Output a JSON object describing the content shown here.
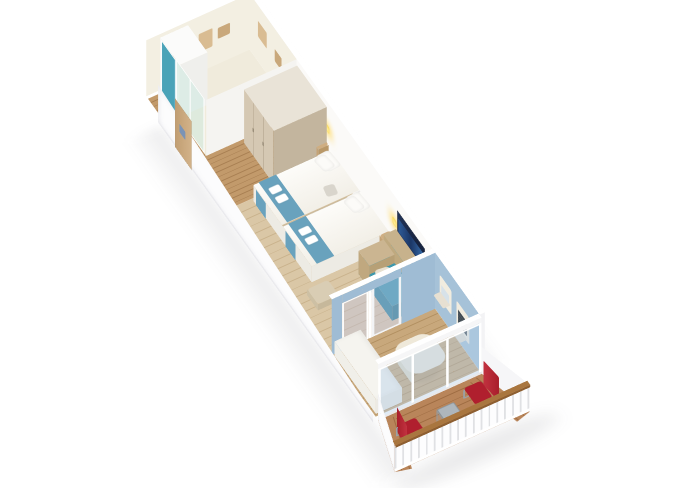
{
  "meta": {
    "description": "3D isometric cutaway render of a ship balcony cabin floor plan on a white background: glass-walled bathroom, entry door, wardrobe, bedroom with two beds, teal chaise sofa, wall TV, blue sitting room with daybed and table, balcony with two red chairs and a small table."
  },
  "palette": {
    "bg": "#ffffff",
    "wall": "#fcfcfd",
    "wall_shade": "#ededf0",
    "cream": "#f0ebdc",
    "cream_wall": "#f3efe2",
    "bath_tan": "#c9a87b",
    "towel_brown": "#a87a58",
    "glass_green": "rgba(200,232,222,0.45)",
    "glass_blue": "rgba(178,205,232,0.42)",
    "glass_lav": "rgba(190,198,235,0.38)",
    "teal": "#4aa3b8",
    "teal_deep": "#35889b",
    "sofa_teal": "#3e98ac",
    "wood_corridor": "#c29a6b",
    "wood_corridor_dark": "#a87f52",
    "wood_bedroom": "#dac7a6",
    "wood_bedroom_dark": "#c9b28c",
    "wood_room2": "#c8a87c",
    "wood_room2_dark": "#b18f60",
    "deck": "#b9855a",
    "deck_dark": "#9e6c42",
    "wardrobe": "#d5c8b3",
    "wardrobe_top": "#e9e3d7",
    "wardrobe_side": "#c3b59e",
    "wardrobe_seam": "#b3a48c",
    "bed_white": "#f7f5f0",
    "bed_front": "#edebe4",
    "runner": "#69a2bd",
    "pillow": "#fcfbf8",
    "tan_cushion": "#c7b28c",
    "tan_dark": "#b39c73",
    "cream_pillow": "#e8e1d1",
    "night_tan": "#cfae82",
    "lamp_yellow": "#f7d34a",
    "blue_wall": "#a6c2d8",
    "blue_wall2": "#9fbcd4",
    "tv_dark": "#17233f",
    "tv_glow": "#2e5f9e",
    "door_wood": "#c8a87c",
    "door_sign": "#7b93b5",
    "daybed": "#f5f4ef",
    "table_top": "#efe9da",
    "unit_cream": "#f1ecdf",
    "unit_dark": "#3f484e",
    "rail_wood": "#a9763f",
    "rail_wood_dark": "#8e5f31",
    "chair_red": "#b01f2e",
    "chair_red_dark": "#8f1a26",
    "chair_frame": "#9aa2a8",
    "metal": "#aeb6bc",
    "shadow": "rgba(60,60,70,0.10)"
  },
  "objects": {
    "bathroom": "glass-walled bathroom with wooden towel racks",
    "entry": "cabin entry door with blue sign",
    "wardrobe": "three-door light wood wardrobe",
    "beds": "two beds with white duvets, teal runners and folded towels",
    "lamps": "two yellow wall lamps",
    "tv": "wall-mounted TV",
    "sofa": "teal chaise sofa with tan cushions",
    "sitting_room": "blue-walled sitting room with white daybed and table",
    "balcony": "wood deck balcony with two red chairs and side table"
  }
}
